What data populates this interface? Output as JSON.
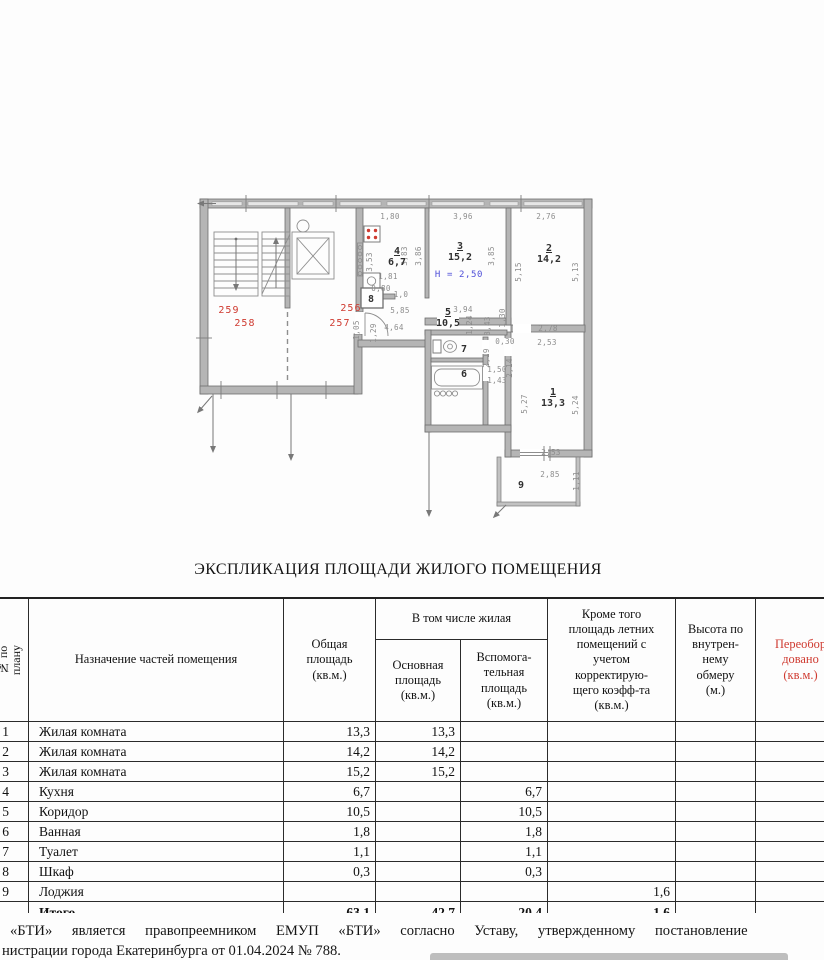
{
  "document": {
    "title": "ЭКСПЛИКАЦИЯ ПЛОЩАДИ ЖИЛОГО ПОМЕЩЕНИЯ",
    "footer_line1": "«БТИ» является правопреемником ЕМУП «БТИ» согласно Уставу, утвержденному постановление",
    "footer_line2": "нистрации города Екатеринбурга от 01.04.2024 № 788."
  },
  "colors": {
    "red_accent": "#cf3a30",
    "blue_note": "#4f4fd8",
    "wall_gray": "#b5b5b5",
    "dim_gray": "#8d8d8d"
  },
  "plan": {
    "ceiling_height_note": "Н = 2,50",
    "unit_numbers": [
      "256",
      "257",
      "258",
      "259"
    ],
    "labels": [
      {
        "t": "1,80",
        "x": 390,
        "y": 219,
        "c": "d"
      },
      {
        "t": "3,96",
        "x": 463,
        "y": 219,
        "c": "d"
      },
      {
        "t": "2,76",
        "x": 546,
        "y": 219,
        "c": "d"
      },
      {
        "t": "1,81",
        "x": 388,
        "y": 279,
        "c": "d"
      },
      {
        "t": "0,80",
        "x": 381,
        "y": 291,
        "c": "d"
      },
      {
        "t": "1,0",
        "x": 401,
        "y": 297,
        "c": "d"
      },
      {
        "t": "5,85",
        "x": 400,
        "y": 313,
        "c": "d"
      },
      {
        "t": "4,64",
        "x": 394,
        "y": 330,
        "c": "d"
      },
      {
        "t": "3,94",
        "x": 463,
        "y": 312,
        "c": "d"
      },
      {
        "t": "2,78",
        "x": 548,
        "y": 331,
        "c": "d"
      },
      {
        "t": "2,53",
        "x": 547,
        "y": 345,
        "c": "d"
      },
      {
        "t": "0,30",
        "x": 505,
        "y": 344,
        "c": "d"
      },
      {
        "t": "1,50",
        "x": 497,
        "y": 372,
        "c": "d"
      },
      {
        "t": "1,43",
        "x": 497,
        "y": 383,
        "c": "d"
      },
      {
        "t": "2,53",
        "x": 551,
        "y": 455,
        "c": "d"
      },
      {
        "t": "2,85",
        "x": 550,
        "y": 477,
        "c": "d"
      },
      {
        "t": "3,53",
        "x": 372,
        "y": 262,
        "c": "v"
      },
      {
        "t": "3,83",
        "x": 407,
        "y": 256,
        "c": "v"
      },
      {
        "t": "3,86",
        "x": 421,
        "y": 256,
        "c": "v"
      },
      {
        "t": "1,05",
        "x": 359,
        "y": 330,
        "c": "v"
      },
      {
        "t": "1,29",
        "x": 376,
        "y": 333,
        "c": "v"
      },
      {
        "t": "1,24",
        "x": 472,
        "y": 325,
        "c": "v"
      },
      {
        "t": "3,43",
        "x": 490,
        "y": 326,
        "c": "v"
      },
      {
        "t": "1,30",
        "x": 505,
        "y": 318,
        "c": "v"
      },
      {
        "t": "3,85",
        "x": 494,
        "y": 256,
        "c": "v"
      },
      {
        "t": "5,15",
        "x": 521,
        "y": 272,
        "c": "v"
      },
      {
        "t": "5,13",
        "x": 578,
        "y": 272,
        "c": "v"
      },
      {
        "t": "2,19",
        "x": 489,
        "y": 358,
        "c": "v"
      },
      {
        "t": "2,14",
        "x": 512,
        "y": 368,
        "c": "v"
      },
      {
        "t": "5,27",
        "x": 527,
        "y": 404,
        "c": "v"
      },
      {
        "t": "5,24",
        "x": 578,
        "y": 405,
        "c": "v"
      },
      {
        "t": "1,11",
        "x": 579,
        "y": 481,
        "c": "v"
      },
      {
        "t": "4",
        "x": 397,
        "y": 254,
        "c": "u"
      },
      {
        "t": "6,7",
        "x": 397,
        "y": 265,
        "c": "r"
      },
      {
        "t": "3",
        "x": 460,
        "y": 249,
        "c": "u"
      },
      {
        "t": "15,2",
        "x": 460,
        "y": 260,
        "c": "r"
      },
      {
        "t": "2",
        "x": 549,
        "y": 251,
        "c": "u"
      },
      {
        "t": "14,2",
        "x": 549,
        "y": 262,
        "c": "r"
      },
      {
        "t": "5",
        "x": 448,
        "y": 315,
        "c": "u"
      },
      {
        "t": "10,5",
        "x": 448,
        "y": 326,
        "c": "r"
      },
      {
        "t": "1",
        "x": 553,
        "y": 395,
        "c": "u"
      },
      {
        "t": "13,3",
        "x": 553,
        "y": 406,
        "c": "r"
      },
      {
        "t": "7",
        "x": 464,
        "y": 352,
        "c": "r"
      },
      {
        "t": "6",
        "x": 464,
        "y": 377,
        "c": "r"
      },
      {
        "t": "8",
        "x": 371,
        "y": 302,
        "c": "r"
      },
      {
        "t": "9",
        "x": 521,
        "y": 488,
        "c": "r"
      },
      {
        "t": "Н = 2,50",
        "x": 459,
        "y": 277,
        "c": "blue"
      },
      {
        "t": "259",
        "x": 229,
        "y": 313,
        "c": "red"
      },
      {
        "t": "258",
        "x": 245,
        "y": 326,
        "c": "red"
      },
      {
        "t": "256",
        "x": 351,
        "y": 311,
        "c": "red"
      },
      {
        "t": "257",
        "x": 340,
        "y": 326,
        "c": "red"
      }
    ]
  },
  "table": {
    "header": {
      "col_plan_no": "№ по\nплану",
      "col_purpose": "Назначение частей помещения",
      "col_total": "Общая\nплощадь\n(кв.м.)",
      "group_living": "В том числе жилая",
      "col_main": "Основная\nплощадь\n(кв.м.)",
      "col_aux": "Вспомога-\nтельная\nплощадь\n(кв.м.)",
      "col_summer": "Кроме того\nплощадь летних\nпомещений с\nучетом\nкорректирую-\nщего коэфф-та\n(кв.м.)",
      "col_height": "Высота по\nвнутрен-\nнему\nобмеру\n(м.)",
      "col_reequipped": "Переобор\nдовано\n(кв.м.)"
    },
    "rows": [
      {
        "no": "1",
        "name": "Жилая комната",
        "total": "13,3",
        "main": "13,3",
        "aux": "",
        "summer": "",
        "height": "",
        "re": ""
      },
      {
        "no": "2",
        "name": "Жилая комната",
        "total": "14,2",
        "main": "14,2",
        "aux": "",
        "summer": "",
        "height": "",
        "re": ""
      },
      {
        "no": "3",
        "name": "Жилая комната",
        "total": "15,2",
        "main": "15,2",
        "aux": "",
        "summer": "",
        "height": "",
        "re": ""
      },
      {
        "no": "4",
        "name": "Кухня",
        "total": "6,7",
        "main": "",
        "aux": "6,7",
        "summer": "",
        "height": "",
        "re": ""
      },
      {
        "no": "5",
        "name": "Коридор",
        "total": "10,5",
        "main": "",
        "aux": "10,5",
        "summer": "",
        "height": "",
        "re": ""
      },
      {
        "no": "6",
        "name": "Ванная",
        "total": "1,8",
        "main": "",
        "aux": "1,8",
        "summer": "",
        "height": "",
        "re": ""
      },
      {
        "no": "7",
        "name": "Туалет",
        "total": "1,1",
        "main": "",
        "aux": "1,1",
        "summer": "",
        "height": "",
        "re": ""
      },
      {
        "no": "8",
        "name": "Шкаф",
        "total": "0,3",
        "main": "",
        "aux": "0,3",
        "summer": "",
        "height": "",
        "re": ""
      },
      {
        "no": "9",
        "name": "Лоджия",
        "total": "",
        "main": "",
        "aux": "",
        "summer": "1,6",
        "height": "",
        "re": ""
      }
    ],
    "total_row": {
      "no": "",
      "name": "Итого",
      "total": "63,1",
      "main": "42,7",
      "aux": "20,4",
      "summer": "1,6",
      "height": "",
      "re": ""
    }
  }
}
